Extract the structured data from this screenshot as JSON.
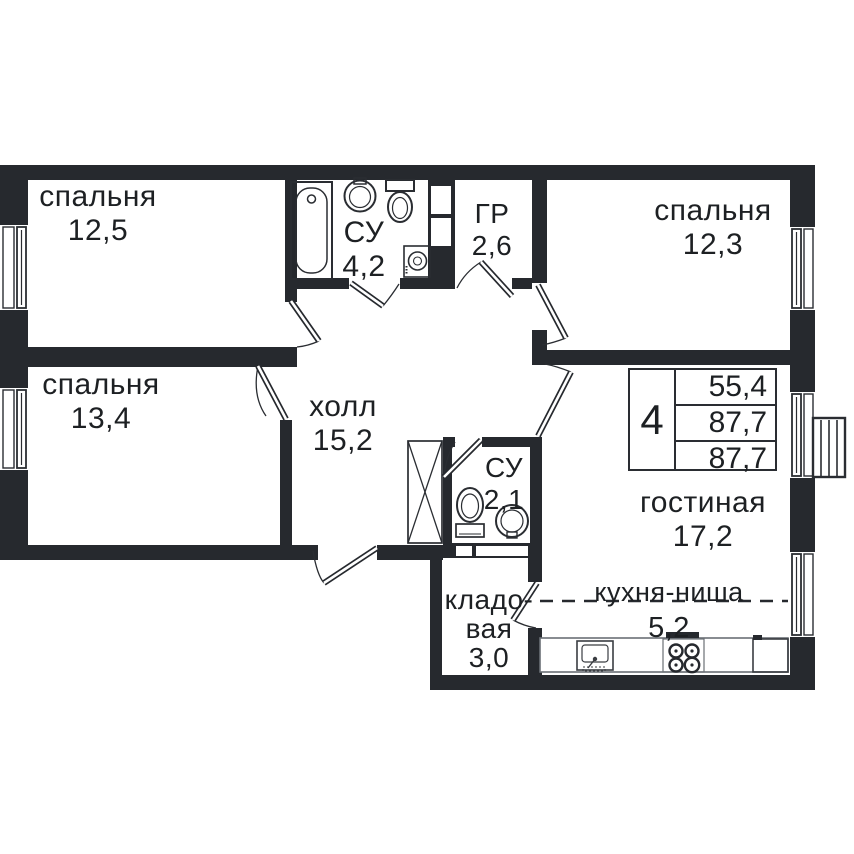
{
  "rooms": {
    "bedroom1": {
      "label": "спальня",
      "area": "12,5"
    },
    "bathroom1": {
      "label": "СУ",
      "area": "4,2"
    },
    "dressing": {
      "label": "ГР",
      "area": "2,6"
    },
    "bedroom2": {
      "label": "спальня",
      "area": "12,3"
    },
    "bedroom3": {
      "label": "спальня",
      "area": "13,4"
    },
    "hall": {
      "label": "холл",
      "area": "15,2"
    },
    "bathroom2": {
      "label": "СУ",
      "area": "2,1"
    },
    "living": {
      "label": "гостиная",
      "area": "17,2"
    },
    "storage": {
      "line1": "кладо-",
      "line2": "вая",
      "area": "3,0"
    },
    "kitchen": {
      "label": "кухня-ниша",
      "area": "5,2"
    }
  },
  "info_box": {
    "rooms_count": "4",
    "living_area": "55,4",
    "total_area": "87,7",
    "total_area_reduced": "87,7"
  },
  "colors": {
    "wall": "#26292e",
    "text": "#1d2023"
  }
}
